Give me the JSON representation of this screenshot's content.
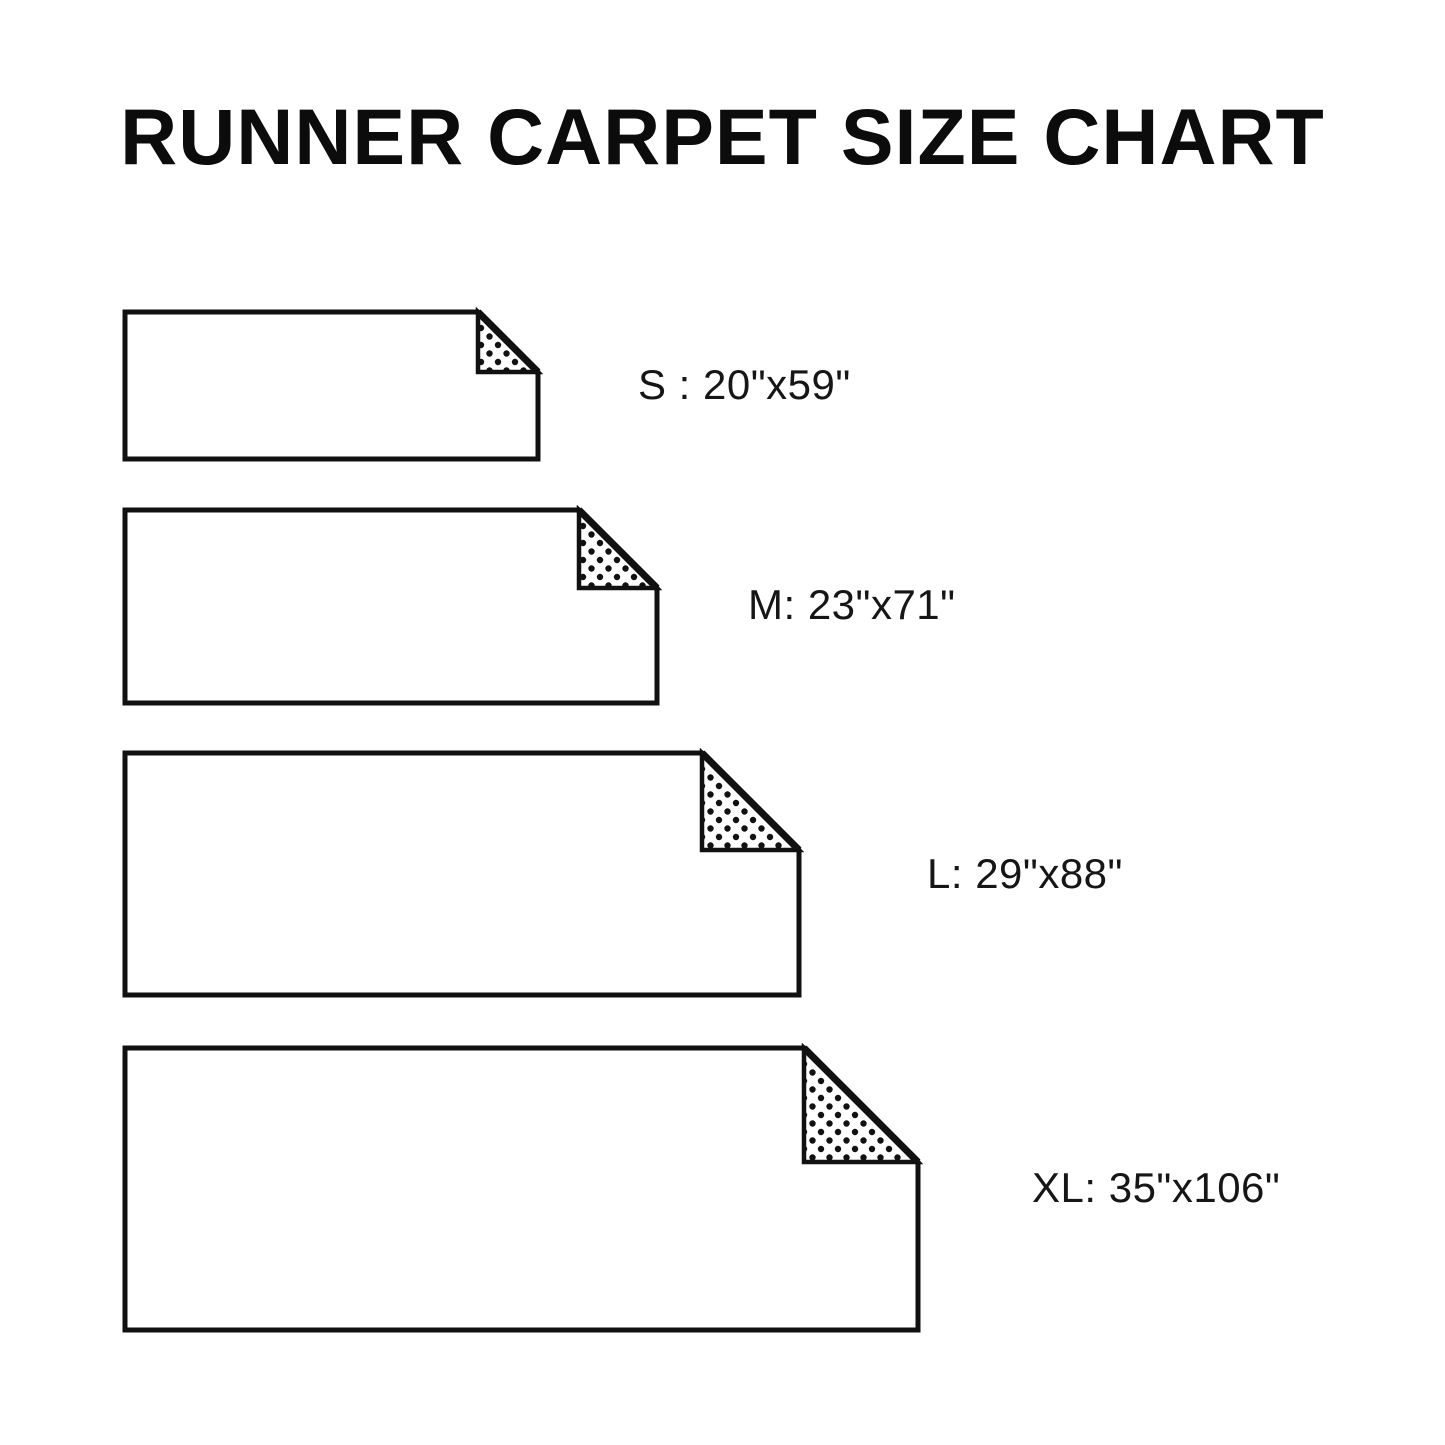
{
  "page": {
    "background": "#ffffff",
    "ink": "#111111",
    "label_color": "#161616",
    "title_color": "#0c0c0c"
  },
  "title": {
    "text": "RUNNER CARPET SIZE CHART"
  },
  "pattern": {
    "name": "polka-dots",
    "dot_radius": 3.2,
    "cell": 17
  },
  "sizes": [
    {
      "id": "s",
      "label": "S : 20\"x59\"",
      "size_code": "S",
      "dimensions": "20\"x59\"",
      "rect": {
        "x": 125,
        "y": 312,
        "w": 413,
        "h": 147,
        "fold": 60
      },
      "label_pos": {
        "x": 638,
        "y": 386
      }
    },
    {
      "id": "m",
      "label": "M: 23\"x71\"",
      "size_code": "M",
      "dimensions": "23\"x71\"",
      "rect": {
        "x": 125,
        "y": 510,
        "w": 532,
        "h": 193,
        "fold": 78
      },
      "label_pos": {
        "x": 748,
        "y": 606
      }
    },
    {
      "id": "l",
      "label": "L: 29\"x88\"",
      "size_code": "L",
      "dimensions": "29\"x88\"",
      "rect": {
        "x": 125,
        "y": 753,
        "w": 674,
        "h": 242,
        "fold": 97
      },
      "label_pos": {
        "x": 927,
        "y": 875
      }
    },
    {
      "id": "xl",
      "label": "XL: 35\"x106\"",
      "size_code": "XL",
      "dimensions": "35\"x106\"",
      "rect": {
        "x": 125,
        "y": 1048,
        "w": 793,
        "h": 282,
        "fold": 114
      },
      "label_pos": {
        "x": 1032,
        "y": 1189
      }
    }
  ]
}
